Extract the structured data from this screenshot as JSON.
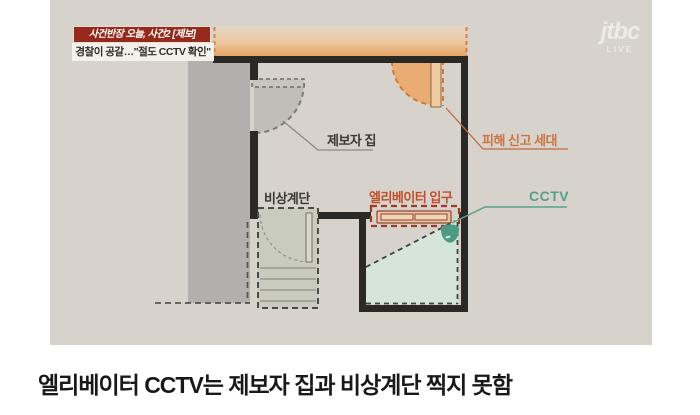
{
  "broadcast": {
    "channel": "jtbc",
    "live_label": "LIVE",
    "badge": {
      "title": "사건반장 오늘, 사건2 [제보]",
      "subtitle": "경찰이 공갈…\"절도 CCTV 확인\""
    }
  },
  "floorplan": {
    "labels": {
      "informant_home": "제보자 집",
      "victim_unit": "피해 신고 세대",
      "emergency_stairs": "비상계단",
      "elevator_entrance": "엘리베이터 입구",
      "cctv": "CCTV"
    },
    "colors": {
      "badge_red": "#96291b",
      "wall_black": "#2b2926",
      "unit_gray": "#b3afac",
      "corridor_orange": "#e5a062",
      "elevator_red": "#9e3a26",
      "victim_label_orange": "#c97743",
      "elevator_label_orange": "#bf4f28",
      "cctv_teal": "#55a18b",
      "coverage_green": "#d5e6d8"
    }
  },
  "caption": "엘리베이터 CCTV는 제보자 집과 비상계단 찍지 못함"
}
